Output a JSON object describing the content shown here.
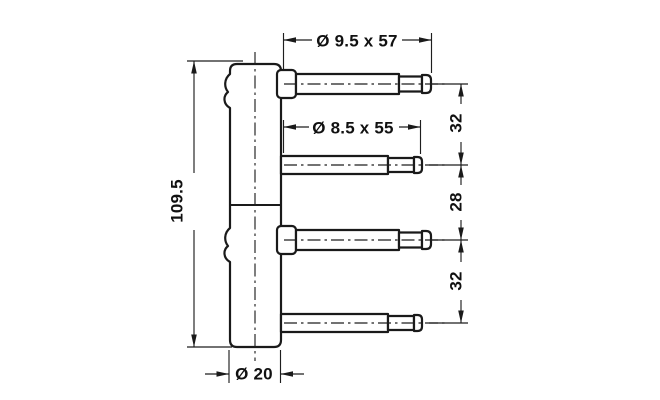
{
  "drawing": {
    "type": "technical-drawing",
    "subject": "drill-in door hinge frame component with four mounting pins",
    "colors": {
      "ink": "#1a1a1a",
      "background": "#ffffff"
    },
    "labels": {
      "pin_top_spec": "Ø 9.5 x 57",
      "pin_mid_spec": "Ø 8.5 x 55",
      "body_length": "109.5",
      "body_diameter": "Ø 20",
      "gap_top": "32",
      "gap_mid": "28",
      "gap_bottom": "32"
    }
  }
}
